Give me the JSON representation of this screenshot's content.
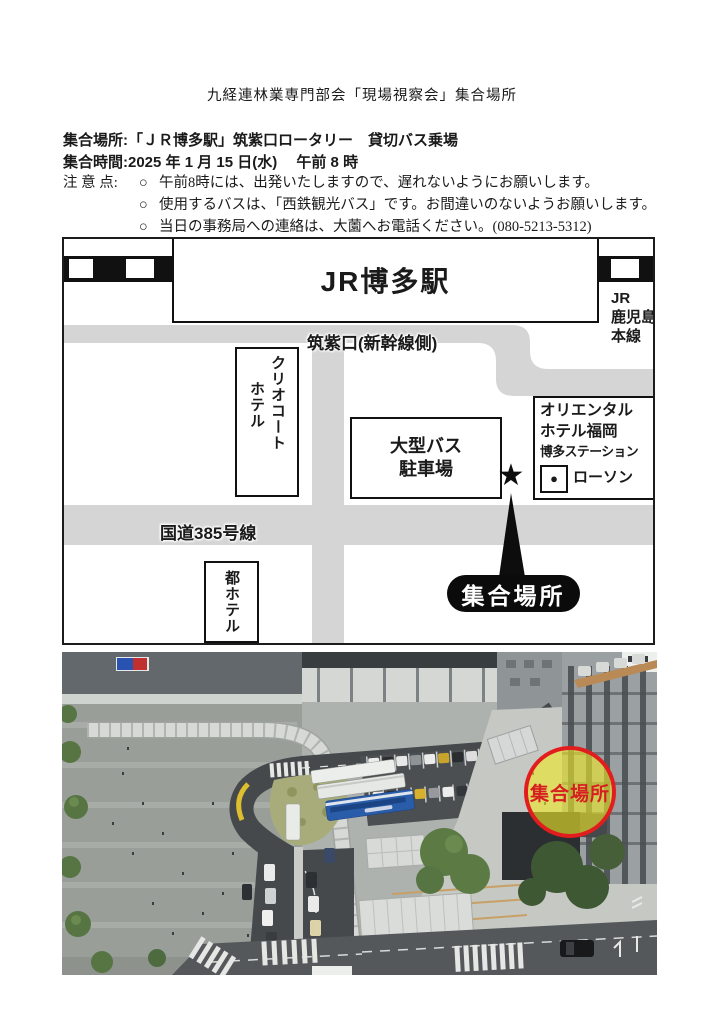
{
  "page": {
    "title": "九経連林業専門部会「現場視察会」集合場所"
  },
  "info": {
    "place_label": "集合場所:",
    "place_value": "「ＪＲ博多駅」筑紫口ロータリー　貸切バス乗場",
    "time_label": "集合時間:",
    "time_value": "2025 年 1 月 15 日(水)　 午前 8 時",
    "notes_label": "注 意 点:",
    "note_bullet": "○",
    "notes": [
      "午前8時には、出発いたしますので、遅れないようにお願いします。",
      "使用するバスは、「西鉄観光バス」です。お間違いのないようお願いします。",
      "当日の事務局への連絡は、大薗へお電話ください。(080-5213-5312)"
    ]
  },
  "map": {
    "station_label": "JR博多駅",
    "exit_label": "筑紫口(新幹線側)",
    "jr_line_lines": [
      "JR",
      "鹿児島",
      "本線"
    ],
    "hotel_clio_col1": "ホテル",
    "hotel_clio_col2": "クリオコート",
    "bus_parking_line1": "大型バス",
    "bus_parking_line2": "駐車場",
    "oriental_line1": "オリエンタル",
    "oriental_line2": "ホテル福岡",
    "oriental_line3": "博多ステーション",
    "lawson_dot": "●",
    "lawson_label": "ローソン",
    "route_label": "国道385号線",
    "miyako_hotel_label": "都ホテル",
    "star_glyph": "★",
    "meeting_label": "集合場所"
  },
  "photo": {
    "marker_label": "集合場所",
    "marker_ring_color": "#e11d1d",
    "marker_fill_color": "rgba(238,232,40,0.62)",
    "marker_text_color": "#d61f1f"
  }
}
